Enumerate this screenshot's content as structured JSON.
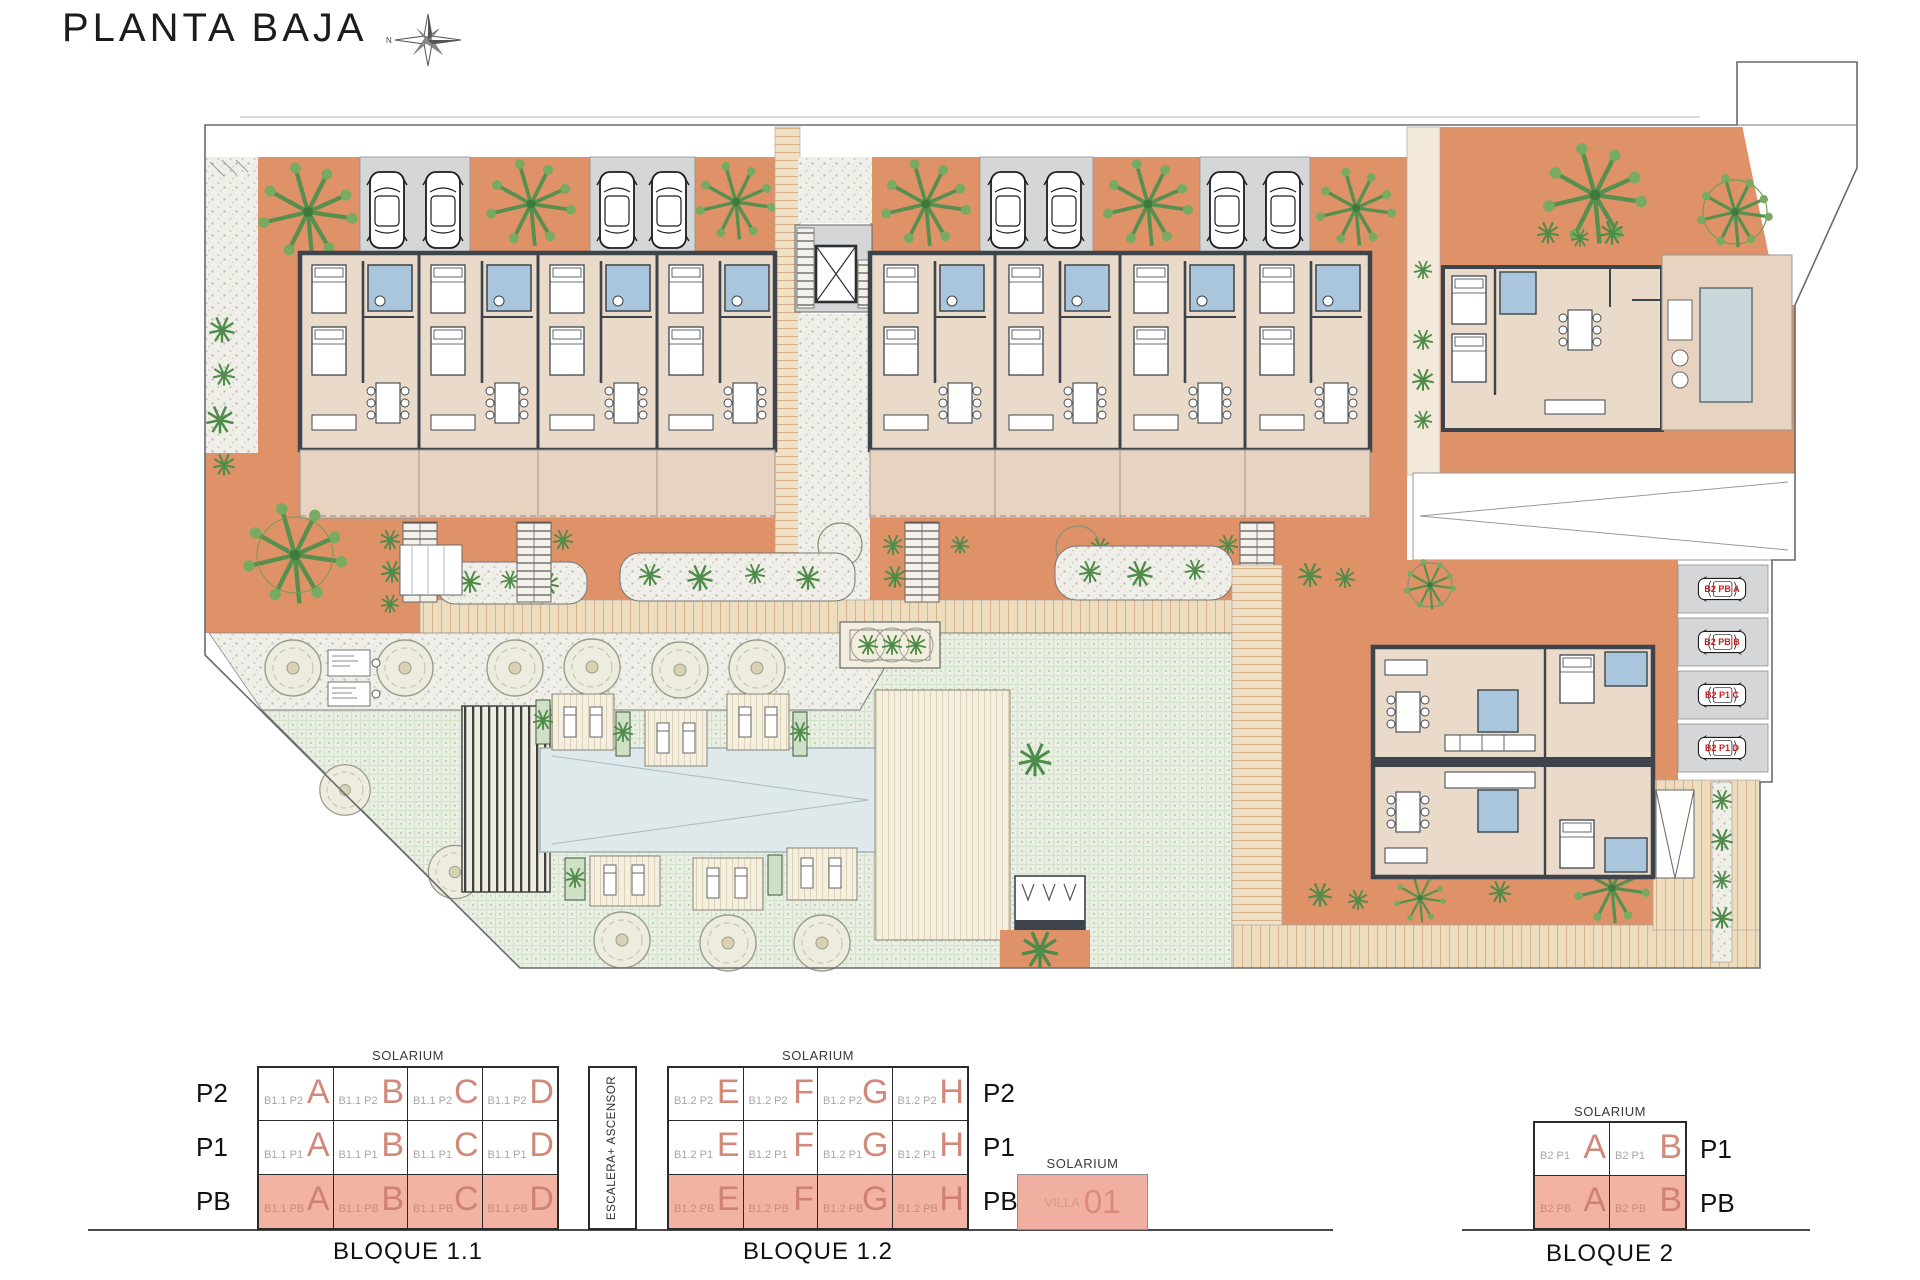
{
  "title": "PLANTA BAJA",
  "compass": {
    "label": "N",
    "icon": "compass-star"
  },
  "plan": {
    "parking_labels": [
      "B2 PB A",
      "B2 PB B",
      "B2 P1 C",
      "B2 P1 D"
    ],
    "colors": {
      "garden_terracotta": "#DF9168",
      "interior_beige": "#EADACA",
      "terrace_beige": "#E7D3BF",
      "parking_gray": "#D5D6D7",
      "bath_blue": "#A9C6DD",
      "lawn_green": "#E9EFE3",
      "pool_blue": "#DFE9EC",
      "legend_pink": "#F2B3A2",
      "letter_salmon": "#D2897A",
      "parking_label_red": "#CC2222"
    }
  },
  "legend": {
    "solarium": "SOLARIUM",
    "escalera": "ESCALERA+ ASCENSOR",
    "bloque11": {
      "name": "BLOQUE 1.1",
      "floors": [
        "P2",
        "P1",
        "PB"
      ],
      "rows": [
        {
          "cells": [
            {
              "code": "B1.1 P2",
              "letter": "A"
            },
            {
              "code": "B1.1 P2",
              "letter": "B"
            },
            {
              "code": "B1.1 P2",
              "letter": "C"
            },
            {
              "code": "B1.1 P2",
              "letter": "D"
            }
          ]
        },
        {
          "cells": [
            {
              "code": "B1.1 P1",
              "letter": "A"
            },
            {
              "code": "B1.1 P1",
              "letter": "B"
            },
            {
              "code": "B1.1 P1",
              "letter": "C"
            },
            {
              "code": "B1.1 P1",
              "letter": "D"
            }
          ]
        },
        {
          "highlight": true,
          "cells": [
            {
              "code": "B1.1 PB",
              "letter": "A"
            },
            {
              "code": "B1.1 PB",
              "letter": "B"
            },
            {
              "code": "B1.1 PB",
              "letter": "C"
            },
            {
              "code": "B1.1 PB",
              "letter": "D"
            }
          ]
        }
      ]
    },
    "bloque12": {
      "name": "BLOQUE 1.2",
      "floors": [
        "P2",
        "P1",
        "PB"
      ],
      "rows": [
        {
          "cells": [
            {
              "code": "B1.2 P2",
              "letter": "E"
            },
            {
              "code": "B1.2 P2",
              "letter": "F"
            },
            {
              "code": "B1.2 P2",
              "letter": "G"
            },
            {
              "code": "B1.2 P2",
              "letter": "H"
            }
          ]
        },
        {
          "cells": [
            {
              "code": "B1.2 P1",
              "letter": "E"
            },
            {
              "code": "B1.2 P1",
              "letter": "F"
            },
            {
              "code": "B1.2 P1",
              "letter": "G"
            },
            {
              "code": "B1.2 P1",
              "letter": "H"
            }
          ]
        },
        {
          "highlight": true,
          "cells": [
            {
              "code": "B1.2 PB",
              "letter": "E"
            },
            {
              "code": "B1.2 PB",
              "letter": "F"
            },
            {
              "code": "B1.2 PB",
              "letter": "G"
            },
            {
              "code": "B1.2 PB",
              "letter": "H"
            }
          ]
        }
      ]
    },
    "villa": {
      "solarium": "SOLARIUM",
      "code": "VILLA",
      "number": "01"
    },
    "bloque2": {
      "name": "BLOQUE 2",
      "floors": [
        "P1",
        "PB"
      ],
      "rows": [
        {
          "cells": [
            {
              "code": "B2 P1",
              "letter": "A"
            },
            {
              "code": "B2 P1",
              "letter": "B"
            }
          ]
        },
        {
          "highlight": true,
          "cells": [
            {
              "code": "B2 PB",
              "letter": "A"
            },
            {
              "code": "B2 PB",
              "letter": "B"
            }
          ]
        }
      ]
    }
  }
}
